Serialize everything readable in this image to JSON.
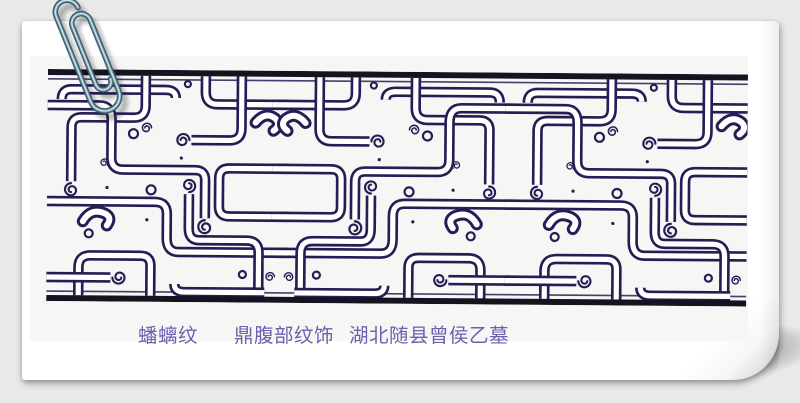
{
  "colors": {
    "bg": "#e9e9e9",
    "card": "#ffffff",
    "tint": "#f6f6f4",
    "ink": "#241e55",
    "bar": "#16121f",
    "caption": "#6b61af"
  },
  "caption": {
    "title": "蟠螭纹",
    "subject": "鼎腹部纹饰",
    "provenance": "湖北随县曾侯乙墓"
  },
  "artwork": {
    "kind": "interlaced pan-chi dragon band, black and indigo line drawing"
  },
  "icons": {
    "paperclip": "paperclip-icon"
  }
}
